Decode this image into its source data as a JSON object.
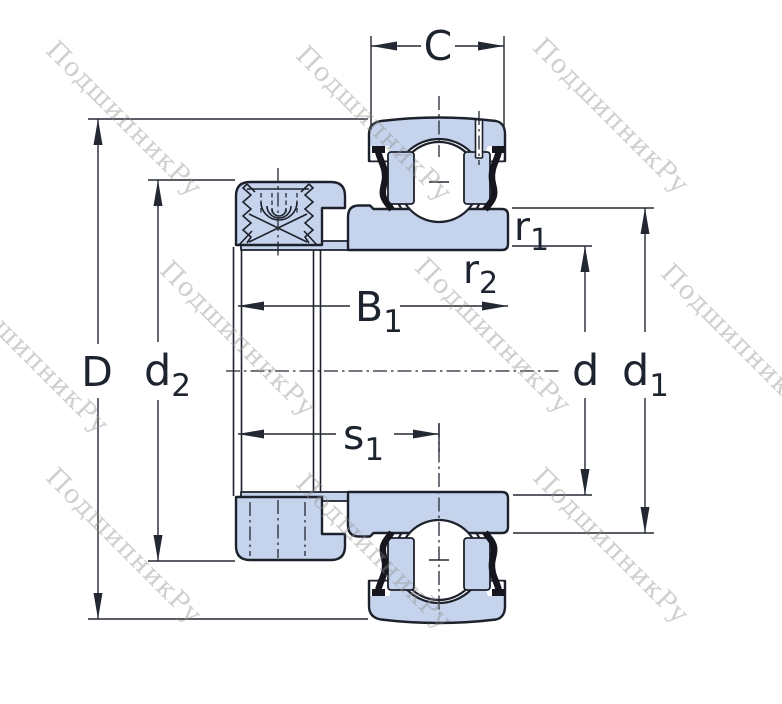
{
  "diagram": {
    "title": "bearing-insert-cross-section",
    "colors": {
      "part_fill": "#c5d4ec",
      "outline": "#1d212b",
      "dimension_lines": "#232832",
      "seal": "#16161e",
      "watermark": "#8f8f8f",
      "background": "#ffffff"
    },
    "watermark": {
      "text": "ПодшипникРу",
      "angle_deg": 45
    },
    "labels": {
      "C": {
        "main": "C",
        "sub": ""
      },
      "D": {
        "main": "D",
        "sub": ""
      },
      "d2": {
        "main": "d",
        "sub": "2"
      },
      "B1": {
        "main": "B",
        "sub": "1"
      },
      "s1": {
        "main": "s",
        "sub": "1"
      },
      "r1": {
        "main": "r",
        "sub": "1"
      },
      "r2": {
        "main": "r",
        "sub": "2"
      },
      "d": {
        "main": "d",
        "sub": ""
      },
      "d1": {
        "main": "d",
        "sub": "1"
      }
    }
  }
}
